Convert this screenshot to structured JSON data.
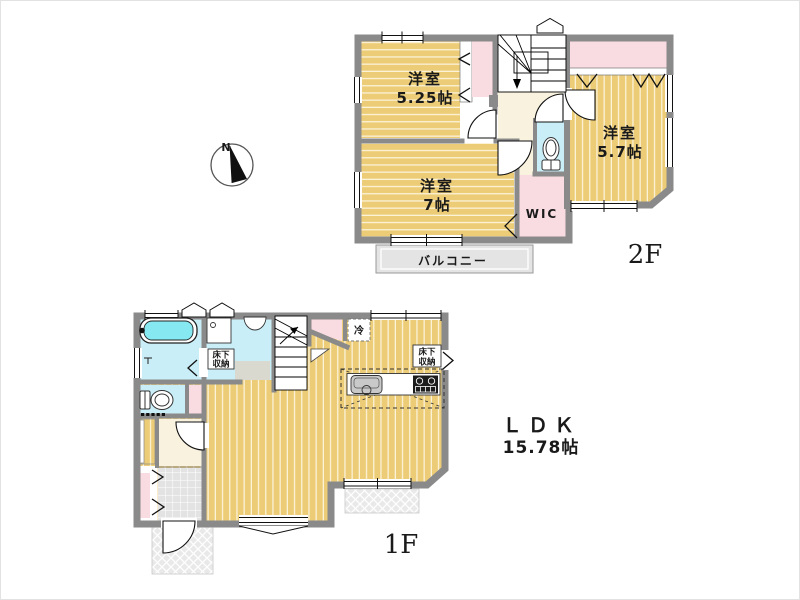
{
  "compass": {
    "north_label": "N"
  },
  "floor2": {
    "floor_label": "2F",
    "room_nw_name": "洋室",
    "room_nw_size": "5.25帖",
    "room_sw_name": "洋室",
    "room_sw_size": "7帖",
    "room_e_name": "洋室",
    "room_e_size": "5.7帖",
    "wic_label": "WIC",
    "balcony_label": "バルコニー"
  },
  "floor1": {
    "floor_label": "1F",
    "ldk_name": "ＬＤＫ",
    "ldk_size": "15.78帖",
    "fridge_label": "冷",
    "underfloor_washroom_line1": "床下",
    "underfloor_washroom_line2": "収納",
    "underfloor_kitchen_line1": "床下",
    "underfloor_kitchen_line2": "収納"
  },
  "colors": {
    "floor_wood_yellow": "#eccc76",
    "wall_gray": "#8a8a8a",
    "closet_pink": "#f9dbe2",
    "wet_room_cyan": "#c9eef7",
    "bathtub_cyan": "#86e9f2",
    "hall_cream": "#f8f2de",
    "balcony_gray": "#e4e4e4",
    "entrance_tile_gray": "#e3e3e3"
  }
}
